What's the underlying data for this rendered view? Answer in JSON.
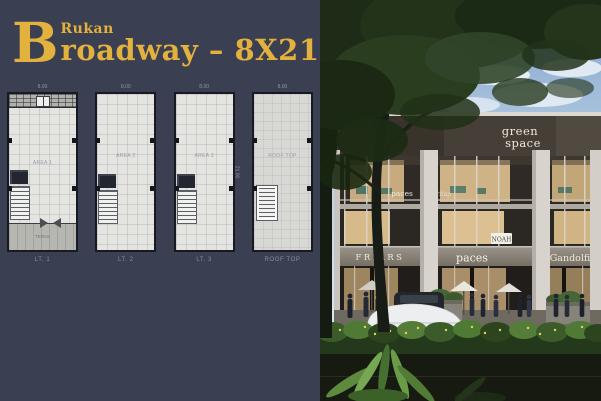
{
  "colors": {
    "background_navy": "#3a3f51",
    "accent_gold": "#e3b13d",
    "plan_floor": "#e4e4e0",
    "photo_sky": "#a9c3dd"
  },
  "header": {
    "kicker": "Rukan",
    "title_initial": "B",
    "title_rest": "roadway – 8X21"
  },
  "floorplans": {
    "side_dim": "21.00",
    "plans": [
      {
        "caption": "LT. 1",
        "area_label": "AREA 1",
        "teras_label": "TERAS",
        "dim_top": "8.00"
      },
      {
        "caption": "LT. 2",
        "area_label": "AREA 2",
        "dim_top": "8.00"
      },
      {
        "caption": "LT. 3",
        "area_label": "AREA 3",
        "dim_top": "8.00"
      },
      {
        "caption": "ROOF TOP",
        "area_label": "ROOF TOP",
        "dim_top": "8.00"
      }
    ]
  },
  "photo": {
    "signs": {
      "rooftop_line1": "green",
      "rooftop_line2": "space",
      "decal_upper_1": "paces",
      "decal_upper_2": "st ritap",
      "decal_small": "NOAH",
      "shop_left": "FRIARS",
      "shop_center": "paces",
      "shop_right": "Gandolfi"
    }
  }
}
